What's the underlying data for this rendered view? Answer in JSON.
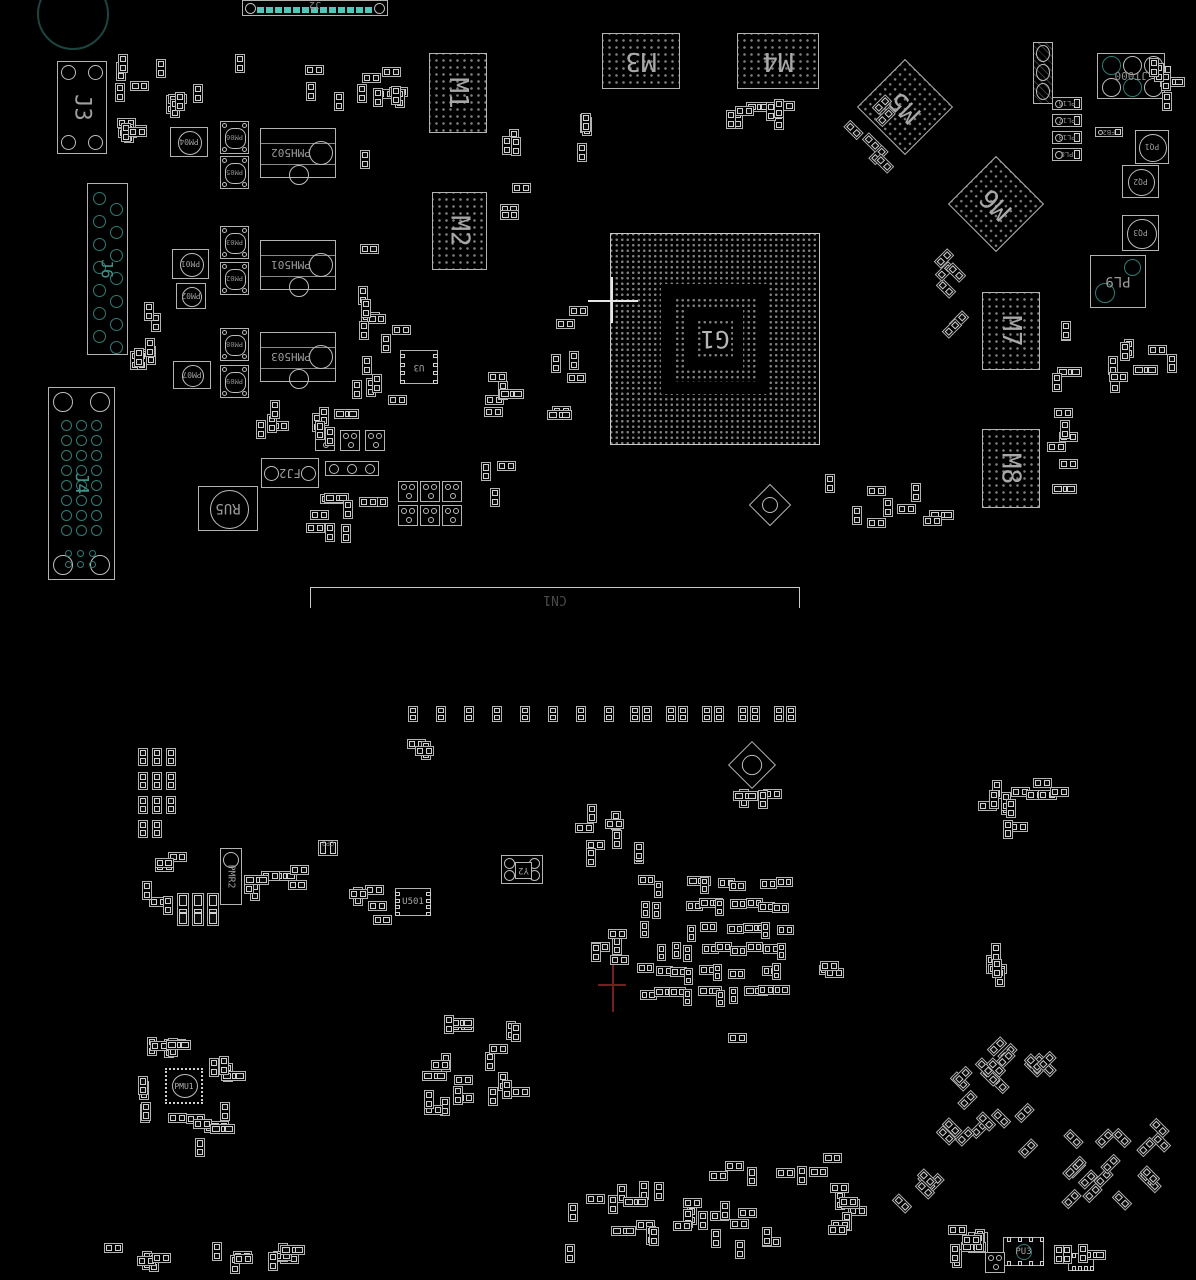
{
  "meta": {
    "description": "PCB assembly placement drawing, bottom side view, black background with silkscreen outlines",
    "view": "bottom",
    "width": 1196,
    "height": 1280
  },
  "colors": {
    "background": "#000000",
    "outline": "#b3b3b3",
    "outline_dim": "#6f6f6f",
    "pad": "#d2d2d2",
    "label": "#9d9d9d",
    "big_label": "#a8a8a8",
    "bga_dot": "#7e7e7e",
    "teal": "#2f7d74",
    "teal_bright": "#56c4b8",
    "origin_cross_white": "#e6e6e6",
    "origin_cross_red": "#742020"
  },
  "board": {
    "bgas": [
      {
        "label": "M1",
        "x": 429,
        "y": 53,
        "w": 58,
        "h": 80,
        "lrot": 90,
        "pitch": 7
      },
      {
        "label": "M2",
        "x": 432,
        "y": 192,
        "w": 55,
        "h": 78,
        "lrot": 90,
        "pitch": 7
      },
      {
        "label": "M3",
        "x": 602,
        "y": 33,
        "w": 78,
        "h": 56,
        "lrot": 180,
        "pitch": 7
      },
      {
        "label": "M4",
        "x": 737,
        "y": 33,
        "w": 82,
        "h": 56,
        "lrot": 180,
        "pitch": 7
      },
      {
        "label": "M5",
        "x": 871,
        "y": 73,
        "w": 68,
        "h": 68,
        "lrot": 180,
        "tilt": 45,
        "pitch": 7
      },
      {
        "label": "M6",
        "x": 962,
        "y": 170,
        "w": 68,
        "h": 68,
        "lrot": 180,
        "tilt": 45,
        "pitch": 7
      },
      {
        "label": "M7",
        "x": 982,
        "y": 292,
        "w": 58,
        "h": 78,
        "lrot": 90,
        "pitch": 7
      },
      {
        "label": "M8",
        "x": 982,
        "y": 429,
        "w": 58,
        "h": 79,
        "lrot": 90,
        "pitch": 7
      }
    ],
    "g1": {
      "label": "G1",
      "x": 610,
      "y": 233,
      "w": 210,
      "h": 212,
      "pitch": 5.5
    },
    "connectors": [
      {
        "type": "j2",
        "label": "J2",
        "x": 242,
        "y": 0,
        "w": 146,
        "h": 16,
        "pads": 13
      },
      {
        "type": "j3",
        "label": "J3",
        "x": 57,
        "y": 61,
        "w": 50,
        "h": 93
      },
      {
        "type": "j6",
        "label": "J6",
        "x": 87,
        "y": 183,
        "w": 41,
        "h": 172,
        "rows": 7
      },
      {
        "type": "j4",
        "label": "J4",
        "x": 48,
        "y": 387,
        "w": 67,
        "h": 193,
        "rows": 8
      },
      {
        "type": "cn1",
        "label": "CN1",
        "x": 310,
        "y": 587,
        "w": 490,
        "h": 21
      },
      {
        "type": "pl9",
        "label": "PL9",
        "x": 1090,
        "y": 255,
        "w": 56,
        "h": 53
      },
      {
        "type": "jt",
        "label": "JT000",
        "x": 1097,
        "y": 53,
        "w": 68,
        "h": 46
      }
    ],
    "round_inductors": [
      {
        "label": "PM04",
        "x": 170,
        "y": 127,
        "w": 38,
        "h": 30
      },
      {
        "label": "PM01",
        "x": 172,
        "y": 249,
        "w": 37,
        "h": 30
      },
      {
        "label": "PM02",
        "x": 176,
        "y": 283,
        "w": 30,
        "h": 26
      },
      {
        "label": "PM07",
        "x": 173,
        "y": 361,
        "w": 38,
        "h": 28
      },
      {
        "label": "RU5",
        "x": 198,
        "y": 486,
        "w": 60,
        "h": 45,
        "big": true
      },
      {
        "label": "PQ1",
        "x": 1135,
        "y": 130,
        "w": 34,
        "h": 34
      },
      {
        "label": "PQ2",
        "x": 1122,
        "y": 165,
        "w": 37,
        "h": 33
      },
      {
        "label": "PQ3",
        "x": 1122,
        "y": 215,
        "w": 37,
        "h": 36
      }
    ],
    "square_inductors": [
      {
        "label": "PM06",
        "x": 220,
        "y": 121,
        "w": 29,
        "h": 33
      },
      {
        "label": "PM05",
        "x": 220,
        "y": 156,
        "w": 29,
        "h": 33
      },
      {
        "label": "PM03",
        "x": 220,
        "y": 226,
        "w": 29,
        "h": 33
      },
      {
        "label": "PM02",
        "x": 220,
        "y": 262,
        "w": 29,
        "h": 33
      },
      {
        "label": "PM08",
        "x": 220,
        "y": 328,
        "w": 29,
        "h": 33
      },
      {
        "label": "PM09",
        "x": 220,
        "y": 365,
        "w": 29,
        "h": 33
      }
    ],
    "modules": [
      {
        "label": "PMH502",
        "x": 260,
        "y": 128,
        "w": 76,
        "h": 50
      },
      {
        "label": "PMH501",
        "x": 260,
        "y": 240,
        "w": 76,
        "h": 50
      },
      {
        "label": "PMH503",
        "x": 260,
        "y": 332,
        "w": 76,
        "h": 50
      }
    ],
    "fj2": {
      "label": "FJ2",
      "x": 261,
      "y": 458,
      "w": 58,
      "h": 30
    },
    "ics": [
      {
        "label": "U3",
        "x": 400,
        "y": 350,
        "w": 38,
        "h": 34,
        "pads": "lr",
        "lrot": 180
      },
      {
        "label": "U501",
        "x": 395,
        "y": 888,
        "w": 36,
        "h": 28,
        "pads": "lr",
        "lrot": 0
      },
      {
        "label": "PU3",
        "x": 1003,
        "y": 1237,
        "w": 41,
        "h": 29,
        "pads": "tb",
        "lrot": 0,
        "circ": true
      },
      {
        "label": "",
        "x": 1068,
        "y": 1253,
        "w": 26,
        "h": 18,
        "pads": "tb",
        "lrot": 0
      }
    ],
    "pl_resistors": [
      {
        "label": "PL16",
        "x": 1052,
        "y": 97,
        "w": 30,
        "h": 13
      },
      {
        "label": "PL17",
        "x": 1052,
        "y": 114,
        "w": 30,
        "h": 13
      },
      {
        "label": "PL13",
        "x": 1052,
        "y": 131,
        "w": 30,
        "h": 13
      },
      {
        "label": "PL8",
        "x": 1052,
        "y": 148,
        "w": 30,
        "h": 13
      },
      {
        "label": "FB2",
        "x": 1095,
        "y": 127,
        "w": 28,
        "h": 10
      }
    ],
    "coil": {
      "x": 1033,
      "y": 42,
      "w": 20,
      "h": 62
    },
    "trimmers": [
      {
        "x": 755,
        "y": 490,
        "w": 30,
        "h": 30
      },
      {
        "x": 735,
        "y": 748,
        "w": 34,
        "h": 34
      }
    ],
    "sots": {
      "w": 20,
      "h": 21,
      "positions": [
        [
          398,
          481
        ],
        [
          420,
          481
        ],
        [
          442,
          481
        ],
        [
          398,
          505
        ],
        [
          420,
          505
        ],
        [
          442,
          505
        ],
        [
          315,
          430
        ],
        [
          340,
          430
        ],
        [
          365,
          430
        ],
        [
          968,
          1232
        ],
        [
          985,
          1252
        ]
      ]
    },
    "rt_bar": {
      "x": 325,
      "y": 461,
      "w": 54,
      "h": 15
    },
    "pmr2": {
      "label": "PMR2",
      "x": 220,
      "y": 848,
      "w": 22,
      "h": 57
    },
    "tall_chips": [
      [
        177,
        893
      ],
      [
        192,
        893
      ],
      [
        207,
        893
      ]
    ],
    "cp2": {
      "label": "CP2",
      "x": 318,
      "y": 840,
      "w": 20,
      "h": 16
    },
    "xtal": {
      "label": "Y2",
      "x": 501,
      "y": 855,
      "w": 42,
      "h": 29
    },
    "qfn": {
      "label": "PMU1",
      "x": 165,
      "y": 1068,
      "w": 38,
      "h": 36
    },
    "chip_row": {
      "y": 706,
      "w": 10,
      "h": 16,
      "xs": [
        408,
        436,
        464,
        492,
        520,
        548,
        576,
        604,
        630,
        642,
        666,
        678,
        702,
        714,
        738,
        750,
        774,
        786
      ]
    },
    "corner_circle": {
      "x": 37,
      "y": -22,
      "d": 72
    },
    "crosses": [
      {
        "color": "#e6e6e6",
        "hx1": 588,
        "hx2": 638,
        "hy": 300,
        "vx": 611,
        "vy1": 277,
        "vy2": 323
      },
      {
        "color": "#742020",
        "hx1": 598,
        "hx2": 626,
        "hy": 984,
        "vx": 612,
        "vy1": 958,
        "vy2": 1012
      }
    ],
    "clusters": [
      {
        "x": 115,
        "y": 38,
        "w": 36,
        "h": 125,
        "n": 10,
        "o": "mix"
      },
      {
        "x": 152,
        "y": 55,
        "w": 65,
        "h": 65,
        "n": 6,
        "o": "mix"
      },
      {
        "x": 232,
        "y": 52,
        "w": 185,
        "h": 65,
        "n": 12,
        "o": "mix"
      },
      {
        "x": 335,
        "y": 130,
        "w": 85,
        "h": 290,
        "n": 14,
        "o": "mix"
      },
      {
        "x": 130,
        "y": 228,
        "w": 42,
        "h": 175,
        "n": 8,
        "o": "v"
      },
      {
        "x": 240,
        "y": 398,
        "w": 150,
        "h": 50,
        "n": 9,
        "o": "mix"
      },
      {
        "x": 300,
        "y": 485,
        "w": 95,
        "h": 85,
        "n": 9,
        "o": "mix"
      },
      {
        "x": 480,
        "y": 368,
        "w": 45,
        "h": 140,
        "n": 8,
        "o": "mix"
      },
      {
        "x": 545,
        "y": 300,
        "w": 48,
        "h": 155,
        "n": 7,
        "o": "mix"
      },
      {
        "x": 495,
        "y": 128,
        "w": 48,
        "h": 135,
        "n": 6,
        "o": "mix"
      },
      {
        "x": 575,
        "y": 95,
        "w": 30,
        "h": 95,
        "n": 4,
        "o": "v"
      },
      {
        "x": 688,
        "y": 95,
        "w": 140,
        "h": 38,
        "n": 8,
        "o": "mix"
      },
      {
        "x": 838,
        "y": 92,
        "w": 62,
        "h": 85,
        "n": 6,
        "o": "d45"
      },
      {
        "x": 938,
        "y": 228,
        "w": 42,
        "h": 125,
        "n": 6,
        "o": "d45"
      },
      {
        "x": 1045,
        "y": 290,
        "w": 38,
        "h": 215,
        "n": 10,
        "o": "mix"
      },
      {
        "x": 1090,
        "y": 328,
        "w": 100,
        "h": 68,
        "n": 8,
        "o": "mix"
      },
      {
        "x": 1148,
        "y": 55,
        "w": 42,
        "h": 70,
        "n": 5,
        "o": "mix"
      },
      {
        "x": 800,
        "y": 468,
        "w": 155,
        "h": 75,
        "n": 9,
        "o": "mix"
      },
      {
        "x": 138,
        "y": 748,
        "w": 40,
        "h": 92,
        "n": 11,
        "o": "grid"
      },
      {
        "x": 138,
        "y": 848,
        "w": 58,
        "h": 72,
        "n": 6,
        "o": "mix"
      },
      {
        "x": 244,
        "y": 855,
        "w": 68,
        "h": 48,
        "n": 7,
        "o": "mix"
      },
      {
        "x": 348,
        "y": 880,
        "w": 50,
        "h": 58,
        "n": 5,
        "o": "mix"
      },
      {
        "x": 575,
        "y": 800,
        "w": 92,
        "h": 72,
        "n": 9,
        "o": "mix"
      },
      {
        "x": 640,
        "y": 878,
        "w": 152,
        "h": 132,
        "n": 52,
        "o": "dense"
      },
      {
        "x": 588,
        "y": 925,
        "w": 46,
        "h": 58,
        "n": 5,
        "o": "mix"
      },
      {
        "x": 805,
        "y": 958,
        "w": 42,
        "h": 30,
        "n": 3,
        "o": "mix"
      },
      {
        "x": 968,
        "y": 778,
        "w": 104,
        "h": 66,
        "n": 13,
        "o": "mix"
      },
      {
        "x": 984,
        "y": 935,
        "w": 34,
        "h": 68,
        "n": 5,
        "o": "mix"
      },
      {
        "x": 938,
        "y": 1035,
        "w": 122,
        "h": 125,
        "n": 22,
        "o": "d45"
      },
      {
        "x": 1058,
        "y": 1122,
        "w": 132,
        "h": 100,
        "n": 16,
        "o": "d45"
      },
      {
        "x": 560,
        "y": 1150,
        "w": 325,
        "h": 118,
        "n": 40,
        "o": "mix"
      },
      {
        "x": 95,
        "y": 1240,
        "w": 220,
        "h": 36,
        "n": 14,
        "o": "mix"
      },
      {
        "x": 420,
        "y": 1008,
        "w": 58,
        "h": 148,
        "n": 12,
        "o": "mix"
      },
      {
        "x": 482,
        "y": 1015,
        "w": 58,
        "h": 105,
        "n": 8,
        "o": "mix"
      },
      {
        "x": 140,
        "y": 1036,
        "w": 82,
        "h": 26,
        "n": 6,
        "o": "mix"
      },
      {
        "x": 138,
        "y": 1068,
        "w": 24,
        "h": 58,
        "n": 4,
        "o": "v"
      },
      {
        "x": 208,
        "y": 1052,
        "w": 36,
        "h": 82,
        "n": 5,
        "o": "mix"
      },
      {
        "x": 148,
        "y": 1108,
        "w": 92,
        "h": 55,
        "n": 7,
        "o": "mix"
      },
      {
        "x": 888,
        "y": 1165,
        "w": 58,
        "h": 58,
        "n": 5,
        "o": "d45"
      },
      {
        "x": 940,
        "y": 1205,
        "w": 58,
        "h": 68,
        "n": 7,
        "o": "mix"
      },
      {
        "x": 1050,
        "y": 1243,
        "w": 60,
        "h": 30,
        "n": 4,
        "o": "mix"
      },
      {
        "x": 720,
        "y": 1032,
        "w": 30,
        "h": 22,
        "n": 1,
        "o": "mix"
      },
      {
        "x": 405,
        "y": 738,
        "w": 55,
        "h": 40,
        "n": 3,
        "o": "mix"
      },
      {
        "x": 728,
        "y": 788,
        "w": 60,
        "h": 30,
        "n": 4,
        "o": "mix"
      }
    ]
  }
}
